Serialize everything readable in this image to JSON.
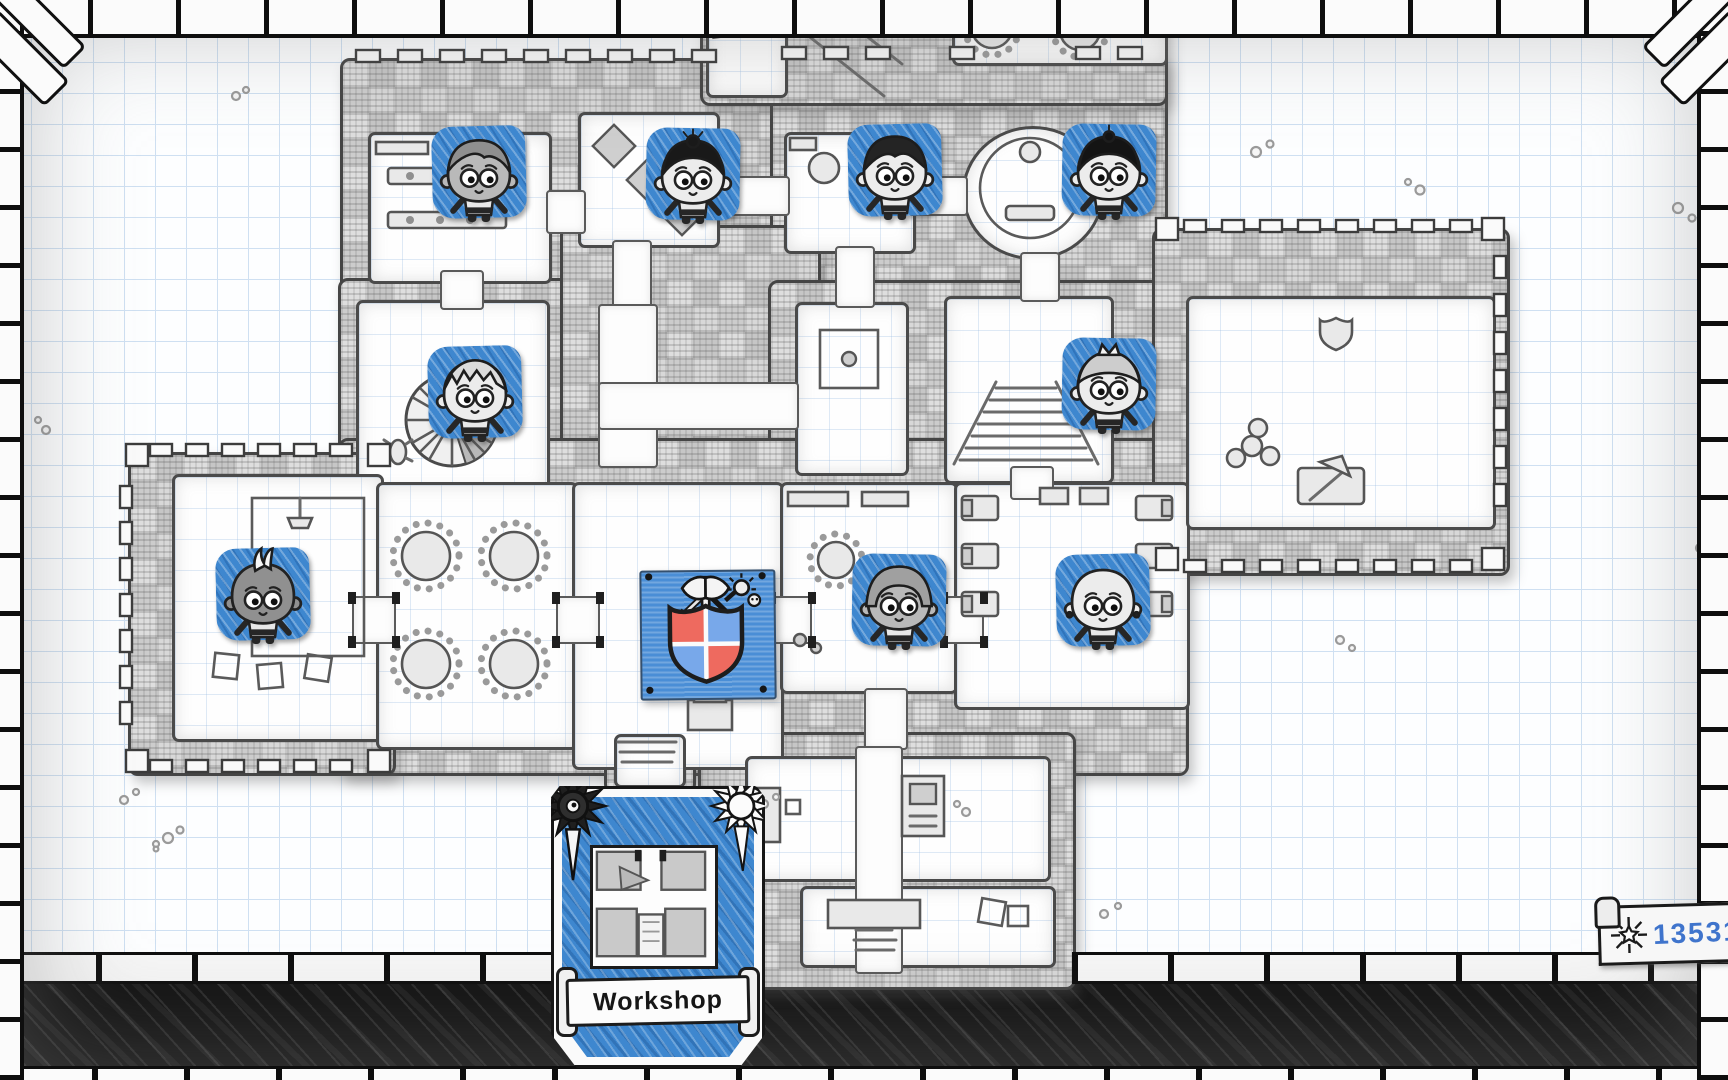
{
  "hud": {
    "gold_counter": {
      "value": "13531",
      "icon": "sunburst-icon"
    },
    "room_card": {
      "label": "Workshop",
      "left_icon": "dark-sun-icon",
      "right_icon": "bright-sun-icon",
      "thumbnail": "workshop-room-map-thumbnail"
    }
  },
  "map": {
    "guild_crest": {
      "icon": "quartered-shield-crest",
      "description": "Blue wall banner bearing a red and blue quartered shield with crossed axe, sword and mace"
    },
    "tokens": [
      {
        "id": "adventurer-1",
        "variant": "parted",
        "skin": "mid",
        "x": 432,
        "y": 126,
        "desc": "adventurer with parted gray hair and striped tunic"
      },
      {
        "id": "adventurer-2",
        "variant": "bun",
        "skin": "light",
        "x": 646,
        "y": 128,
        "desc": "adventurer with dark bun and chalice tabard"
      },
      {
        "id": "adventurer-3",
        "variant": "sideswept",
        "skin": "light",
        "x": 848,
        "y": 124,
        "desc": "adventurer with side-swept dark hair and gray coat"
      },
      {
        "id": "adventurer-4",
        "variant": "topknot",
        "skin": "light",
        "x": 1062,
        "y": 124,
        "desc": "adventurer with dark topknot and white robes"
      },
      {
        "id": "adventurer-5",
        "variant": "spiky",
        "skin": "light",
        "x": 428,
        "y": 346,
        "desc": "adventurer with spiky pale hair and crossed straps"
      },
      {
        "id": "adventurer-6",
        "variant": "crown",
        "skin": "light",
        "x": 1062,
        "y": 338,
        "desc": "adventurer with tiny crown and striped shirt"
      },
      {
        "id": "adventurer-7",
        "variant": "mohawk",
        "skin": "dark",
        "x": 216,
        "y": 548,
        "desc": "adventurer with pale mohawk and leather vest"
      },
      {
        "id": "adventurer-8",
        "variant": "bowl",
        "skin": "mid",
        "x": 852,
        "y": 554,
        "desc": "adventurer with bowl-cut hair and skull shirt"
      },
      {
        "id": "adventurer-9",
        "variant": "bald",
        "skin": "light",
        "x": 1056,
        "y": 554,
        "desc": "bald adventurer with earrings and white tunic"
      }
    ]
  },
  "colors": {
    "token_blue": "#3e87cf",
    "card_blue": "#3e87cf",
    "banner_blue": "#4a8ed6",
    "shield_red": "#ee6a5f",
    "shield_blue": "#78a8ea",
    "gold_text_blue": "#3f74cc",
    "paper_grid_blue": "#cfe0f2",
    "ink_black": "#141414",
    "wall_gray": "#c9c9c9"
  }
}
